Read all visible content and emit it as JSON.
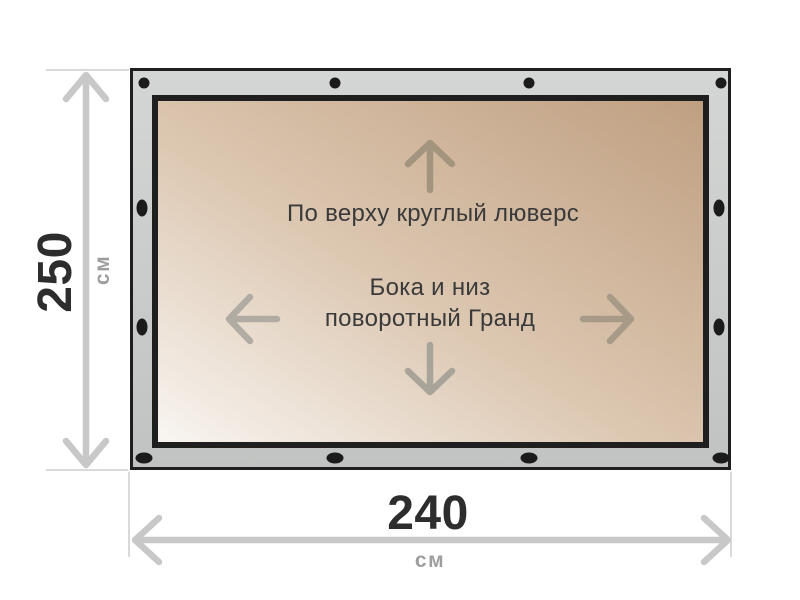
{
  "diagram": {
    "top_label": "По верху круглый люверс",
    "sides_label_line1": "Бока и низ",
    "sides_label_line2": "поворотный Гранд",
    "height_dimension": {
      "value": "250",
      "unit": "см"
    },
    "width_dimension": {
      "value": "240",
      "unit": "см"
    },
    "icons": [
      "arrow-up-icon",
      "arrow-down-icon",
      "arrow-left-icon",
      "arrow-right-icon",
      "grommet-icon"
    ],
    "colors": {
      "background": "#ffffff",
      "frame_fill": "#cacccb",
      "frame_outline": "#1f1f1f",
      "canvas_light": "#f9f6f2",
      "canvas_dark": "#bf9f81",
      "grommet": "#1b1b1b",
      "dimension_line": "#c8c8c8",
      "extension_line": "#d9d9d9",
      "dimension_value_text": "#2d2d2d",
      "unit_text": "#9e9e9e",
      "label_text": "#3a3a3a",
      "direction_arrow": "#a79a86"
    }
  }
}
